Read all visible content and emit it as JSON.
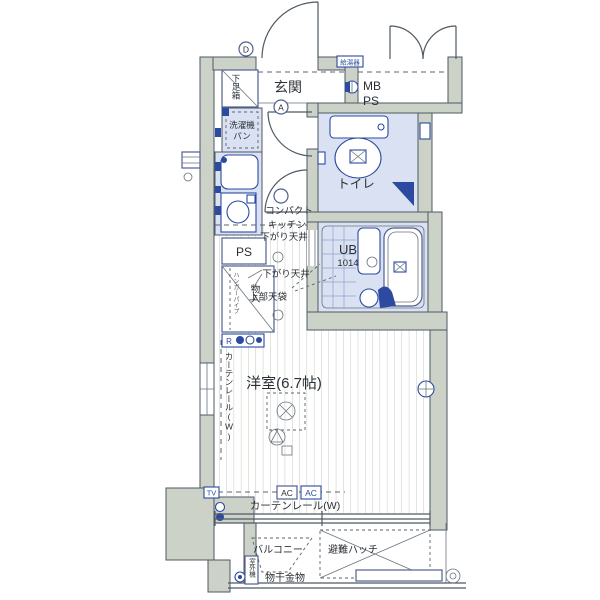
{
  "colors": {
    "wall": "#ccd2c8",
    "wet_area": "#d9e1f2",
    "accent_blue": "#2b4aa0",
    "outline": "#4e5a64"
  },
  "labels": {
    "entrance": "玄関",
    "shoe_box": "下足箱",
    "mb": "MB",
    "ps_meter": "PS",
    "water_heater": "給湯器",
    "laundry_pan_1": "洗濯機",
    "laundry_pan_2": "パン",
    "toilet": "トイレ",
    "ub": "UB",
    "ub_size": "1014",
    "kitchen_1": "コンパクト",
    "kitchen_2": "キッチン",
    "pipe_space": "PS",
    "closet": "物入",
    "hanger_pipe": "ハンガーパイプ",
    "lowered_ceiling_1": "下がり天井",
    "lowered_ceiling_2": "下がり天井",
    "upper_cabinet": "上部天袋",
    "western_room": "洋室(6.7帖)",
    "curtain_rail_left": "カーテンレール(W)",
    "curtain_rail_bottom": "カーテンレール(W)",
    "ac_1": "AC",
    "ac_2": "AC",
    "tv_outlet": "TV",
    "outlet_r": "R",
    "balcony": "バルコニー",
    "escape_hatch": "避難ハッチ",
    "laundry_hardware": "物干金物",
    "outdoor_unit": "室外機",
    "mark_d": "D",
    "mark_a": "A"
  }
}
